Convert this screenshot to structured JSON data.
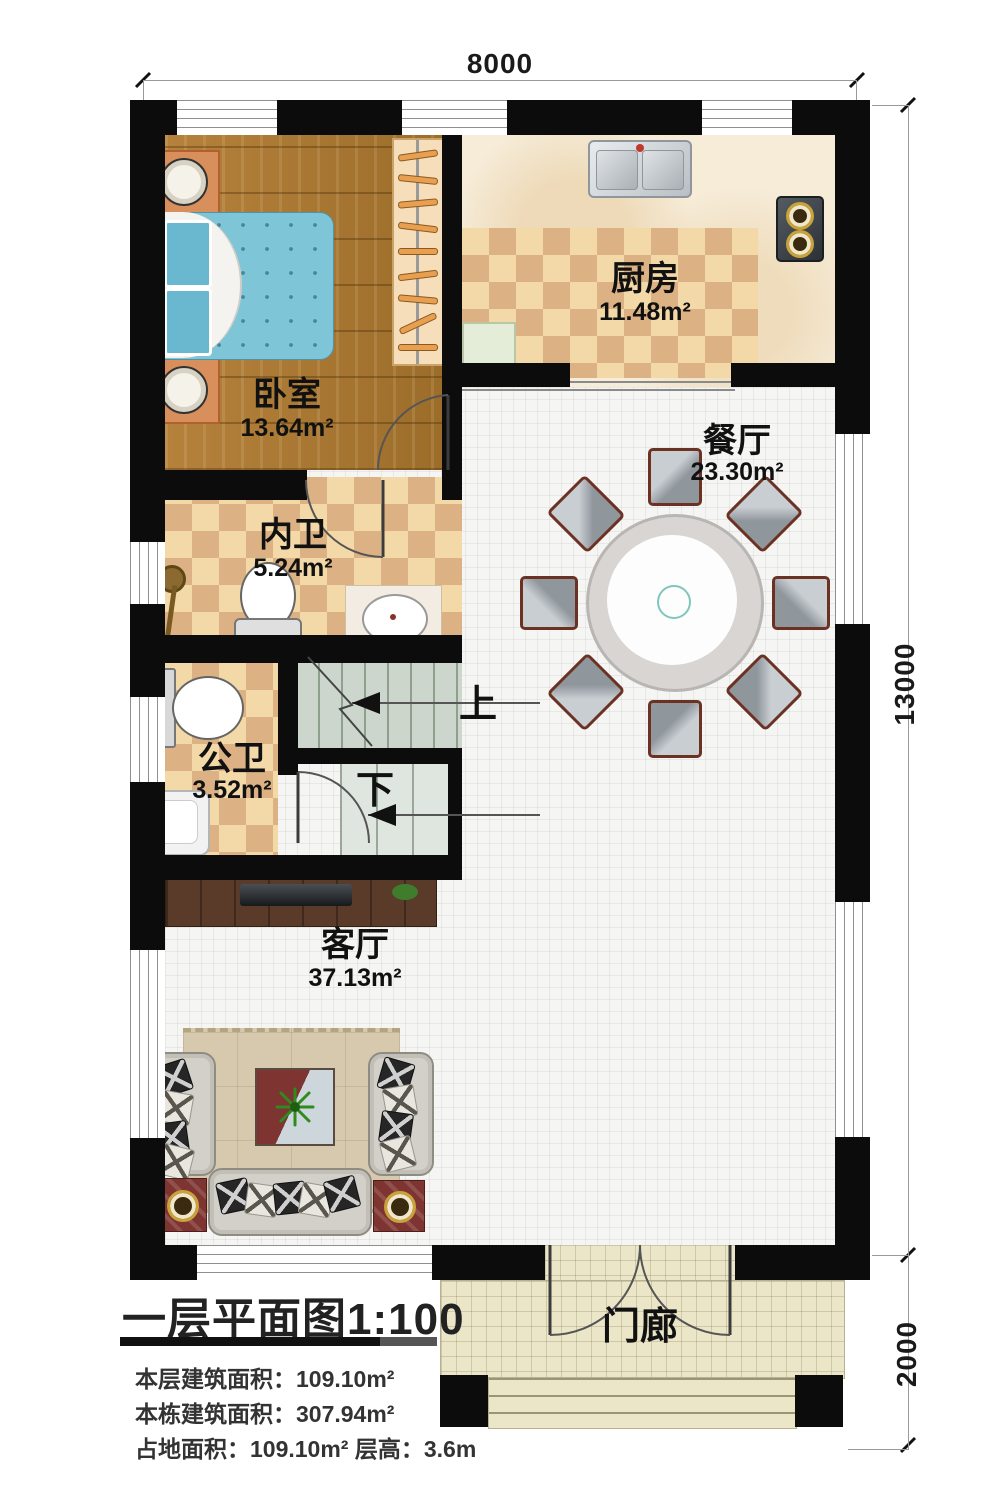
{
  "title_block": {
    "title": "一层平面图1:100",
    "line1": "本层建筑面积：109.10m²",
    "line2": "本栋建筑面积：307.94m²",
    "line3": "占地面积：109.10m²  层高：3.6m"
  },
  "dimensions": {
    "top": "8000",
    "side": "13000",
    "porch": "2000"
  },
  "rooms": {
    "bedroom": {
      "name": "卧室",
      "area": "13.64m²"
    },
    "kitchen": {
      "name": "厨房",
      "area": "11.48m²"
    },
    "dining": {
      "name": "餐厅",
      "area": "23.30m²"
    },
    "inner_bath": {
      "name": "内卫",
      "area": "5.24m²"
    },
    "public_bath": {
      "name": "公卫",
      "area": "3.52m²"
    },
    "living": {
      "name": "客厅",
      "area": "37.13m²"
    },
    "porch": {
      "name": "门廊"
    }
  },
  "stairs": {
    "up_label": "上",
    "down_label": "下"
  },
  "colors": {
    "wall": "#0c0c0c",
    "wood_floor": "#a9772e",
    "checker_light": "#f4d9a8",
    "checker_dark": "#dcb284",
    "tile": "#f5f5f3",
    "porch_tile": "#ece6c9",
    "stair": "#ccd6cc",
    "accent_red": "#7e3430",
    "bed_blue": "#7ec5d8"
  }
}
